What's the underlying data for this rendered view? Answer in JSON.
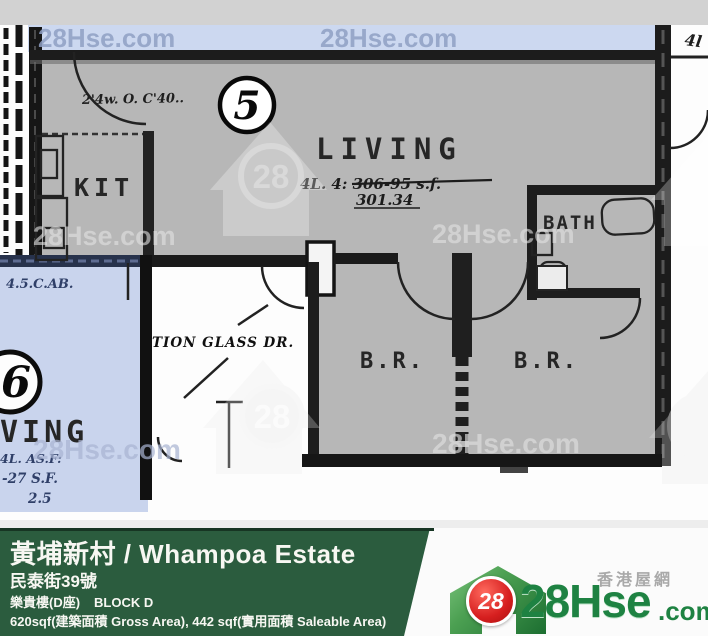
{
  "watermark": {
    "text": "28Hse.com",
    "badge": "28"
  },
  "plan": {
    "unit5": {
      "number": "5",
      "living": "LIVING",
      "note1": "4L. 4: 306-95 s.f.",
      "note2": "301.34",
      "kit": "KIT",
      "bath": "BATH",
      "br1": "B.R.",
      "br2": "B.R.",
      "door_note": "2'4w. O. C'40..",
      "right_note": "4l"
    },
    "unit6": {
      "number": "6",
      "living": "VING",
      "note1": "4.5.C.AB.",
      "note2": "4L. AS.F:",
      "note3": "-27 S.F.",
      "note4": "2.5"
    },
    "entrance": {
      "note": "TION GLASS DR."
    }
  },
  "footer": {
    "title": "黃埔新村 / Whampoa Estate",
    "address": "民泰街39號",
    "block_cn": "樂貴樓(D座)",
    "block_en": "BLOCK D",
    "area": "620sqf(建築面積 Gross Area), 442 sqf(實用面積 Saleable Area)",
    "brand": {
      "number": "28",
      "name": "28Hse",
      "tld": ".com",
      "tagline": "香港屋網"
    }
  },
  "colors": {
    "footer_green": "#2b5c3e",
    "logo_green": "#1e8242",
    "logo_red": "#d61f1f",
    "plan_gray": "#b7b7b7",
    "plan_blue": "#c9d4ed",
    "band_blue": "#ccd8f0"
  }
}
